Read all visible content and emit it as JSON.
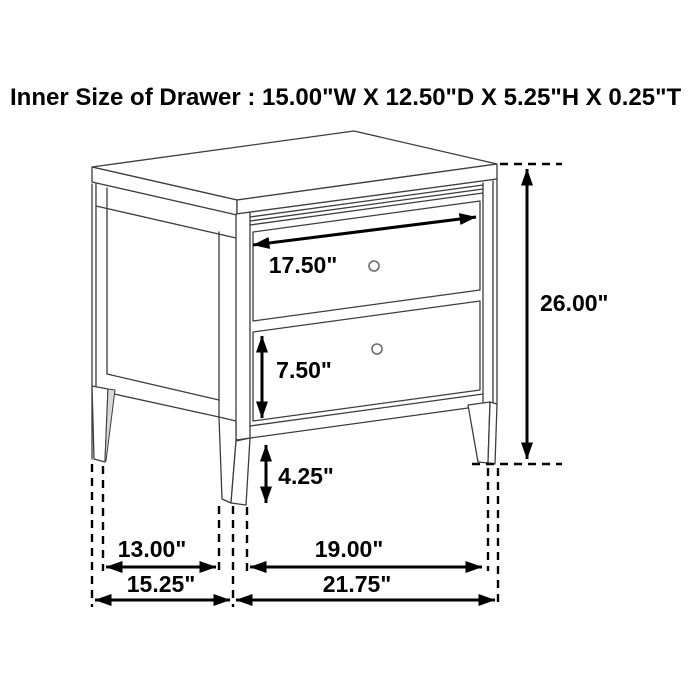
{
  "title": "Inner Size of Drawer : 15.00\"W X 12.50\"D X 5.25\"H X 0.25\"T",
  "diagram": {
    "item": "two-drawer nightstand dimension drawing",
    "dims": {
      "drawer_width": "17.50\"",
      "drawer_height": "7.50\"",
      "leg_clearance": "4.25\"",
      "overall_height": "26.00\"",
      "depth_inner": "13.00\"",
      "depth_outer": "15.25\"",
      "width_inner": "19.00\"",
      "width_outer": "21.75\""
    },
    "colors": {
      "background": "#ffffff",
      "furniture_line": "#3d3d3d",
      "dimension_line": "#000000",
      "text": "#000000"
    }
  }
}
